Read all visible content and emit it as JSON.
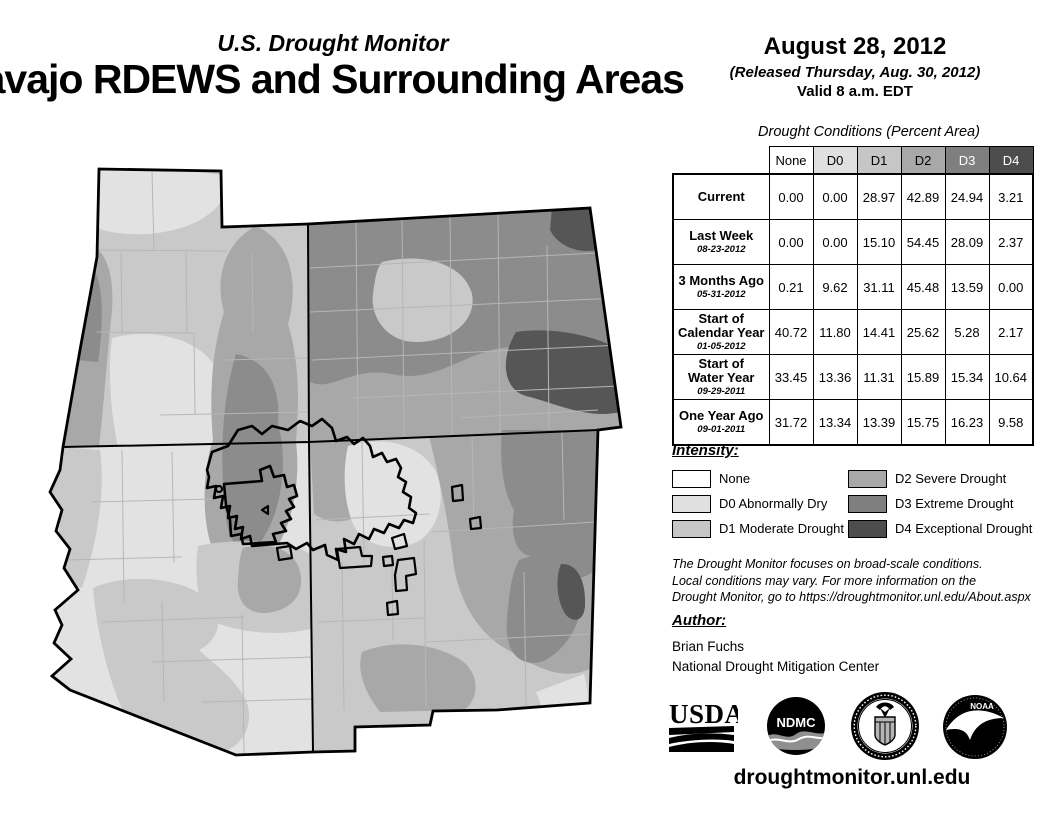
{
  "header": {
    "monitor_title": "U.S. Drought Monitor",
    "region_title": "Navajo RDEWS and Surrounding Areas",
    "date": "August 28, 2012",
    "released": "(Released Thursday, Aug. 30, 2012)",
    "valid": "Valid 8 a.m. EDT"
  },
  "table": {
    "title": "Drought Conditions (Percent Area)",
    "columns": [
      "None",
      "D0",
      "D1",
      "D2",
      "D3",
      "D4"
    ],
    "column_colors": [
      "#ffffff",
      "#e0e0e0",
      "#c6c6c6",
      "#a8a8a8",
      "#7f7f7f",
      "#4d4d4d"
    ],
    "rows": [
      {
        "l1": "Current",
        "l2": "",
        "date": "",
        "v": [
          "0.00",
          "0.00",
          "28.97",
          "42.89",
          "24.94",
          "3.21"
        ]
      },
      {
        "l1": "Last Week",
        "l2": "",
        "date": "08-23-2012",
        "v": [
          "0.00",
          "0.00",
          "15.10",
          "54.45",
          "28.09",
          "2.37"
        ]
      },
      {
        "l1": "3 Months Ago",
        "l2": "",
        "date": "05-31-2012",
        "v": [
          "0.21",
          "9.62",
          "31.11",
          "45.48",
          "13.59",
          "0.00"
        ]
      },
      {
        "l1": "Start of",
        "l2": "Calendar Year",
        "date": "01-05-2012",
        "v": [
          "40.72",
          "11.80",
          "14.41",
          "25.62",
          "5.28",
          "2.17"
        ]
      },
      {
        "l1": "Start of",
        "l2": "Water Year",
        "date": "09-29-2011",
        "v": [
          "33.45",
          "13.36",
          "11.31",
          "15.89",
          "15.34",
          "10.64"
        ]
      },
      {
        "l1": "One Year Ago",
        "l2": "",
        "date": "09-01-2011",
        "v": [
          "31.72",
          "13.34",
          "13.39",
          "15.75",
          "16.23",
          "9.58"
        ]
      }
    ]
  },
  "legend": {
    "heading": "Intensity:",
    "items": [
      {
        "label": "None",
        "color": "#ffffff"
      },
      {
        "label": "D0 Abnormally Dry",
        "color": "#e0e0e0"
      },
      {
        "label": "D1 Moderate Drought",
        "color": "#c6c6c6"
      },
      {
        "label": "D2 Severe Drought",
        "color": "#a8a8a8"
      },
      {
        "label": "D3 Extreme Drought",
        "color": "#7f7f7f"
      },
      {
        "label": "D4 Exceptional Drought",
        "color": "#4d4d4d"
      }
    ]
  },
  "disclaimer": {
    "lines": [
      "The Drought Monitor focuses on broad-scale conditions.",
      "Local conditions may vary. For more information on the",
      "Drought Monitor, go to https://droughtmonitor.unl.edu/About.aspx"
    ]
  },
  "author": {
    "heading": "Author:",
    "name": "Brian Fuchs",
    "org": "National Drought Mitigation Center"
  },
  "footer": {
    "url": "droughtmonitor.unl.edu",
    "logos": {
      "usda": "USDA",
      "ndmc": "NDMC",
      "noaa": "NOAA"
    }
  },
  "map": {
    "palette": {
      "none": "#ffffff",
      "d0": "#e2e2e2",
      "d1": "#c9c9c9",
      "d2": "#a8a8a8",
      "d3": "#8c8c8c",
      "d4": "#565656"
    }
  }
}
